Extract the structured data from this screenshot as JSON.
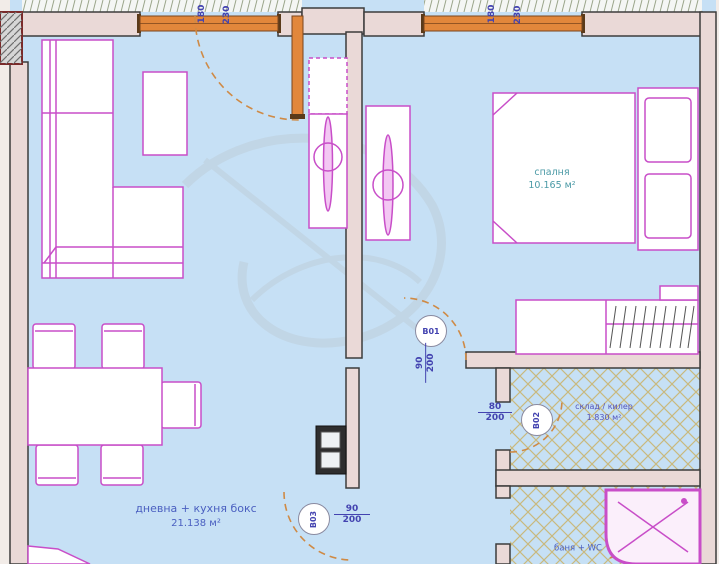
{
  "rooms": {
    "living": {
      "name": "дневна + кухня бокс",
      "area": "21.138 м²"
    },
    "bedroom": {
      "name": "спалня",
      "area": "10.165 м²"
    },
    "storage": {
      "name": "склад / килер",
      "area": "1.830 м²"
    },
    "bath": {
      "name": "баня + WC"
    }
  },
  "doors": {
    "b01": {
      "id": "B01",
      "w": "90",
      "h": "200"
    },
    "b02": {
      "id": "B02",
      "w": "80",
      "h": "200"
    },
    "b03": {
      "id": "B03",
      "w": "90",
      "h": "200"
    }
  },
  "windows": {
    "w1": {
      "width": "180",
      "height": "230"
    },
    "w2": {
      "width": "180",
      "height": "230"
    }
  },
  "colors": {
    "floor_blue": "#c6e0f5",
    "wall_fill": "#ead9d7",
    "wall_line": "#3c3c3c",
    "furniture_magenta": "#c84ec8",
    "joinery_orange": "#e2873b",
    "door_swing_dash": "#cf8a45",
    "label_blue": "#4a5fc0",
    "dimension_blue": "#4343b0",
    "bedroom_label_teal": "#4b9aa6",
    "floor_lattice_tan": "#c9b97e"
  }
}
